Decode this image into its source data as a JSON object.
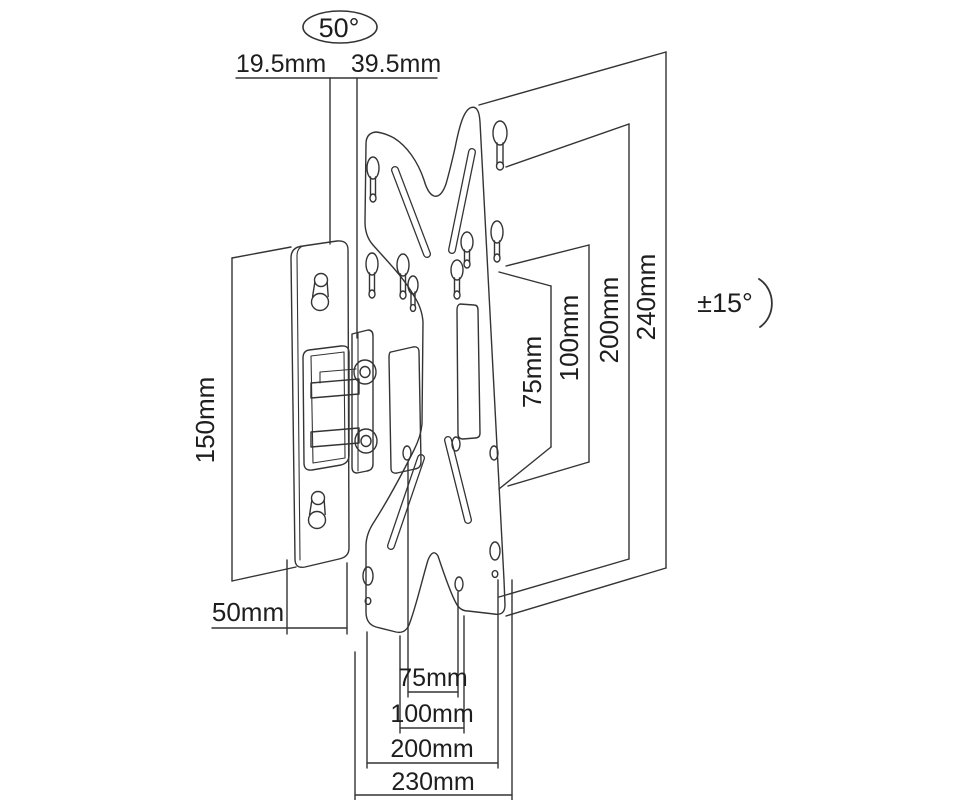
{
  "diagram": {
    "type": "technical-drawing",
    "subject": "Tilt and swivel TV wall mount bracket dimension drawing",
    "colors": {
      "line": "#343434",
      "text": "#1e1e1e",
      "background": "#ffffff"
    },
    "labels": {
      "swivel_angle": "50°",
      "tilt_angle": "±15°",
      "top_left_offset": "19.5mm",
      "top_right_offset": "39.5mm",
      "wall_plate_height": "150mm",
      "wall_plate_width": "50mm",
      "bottom_width_75": "75mm",
      "bottom_width_100": "100mm",
      "bottom_width_200": "200mm",
      "bottom_width_230": "230mm",
      "side_height_75": "75mm",
      "side_height_100": "100mm",
      "side_height_200": "200mm",
      "side_height_240": "240mm"
    }
  }
}
